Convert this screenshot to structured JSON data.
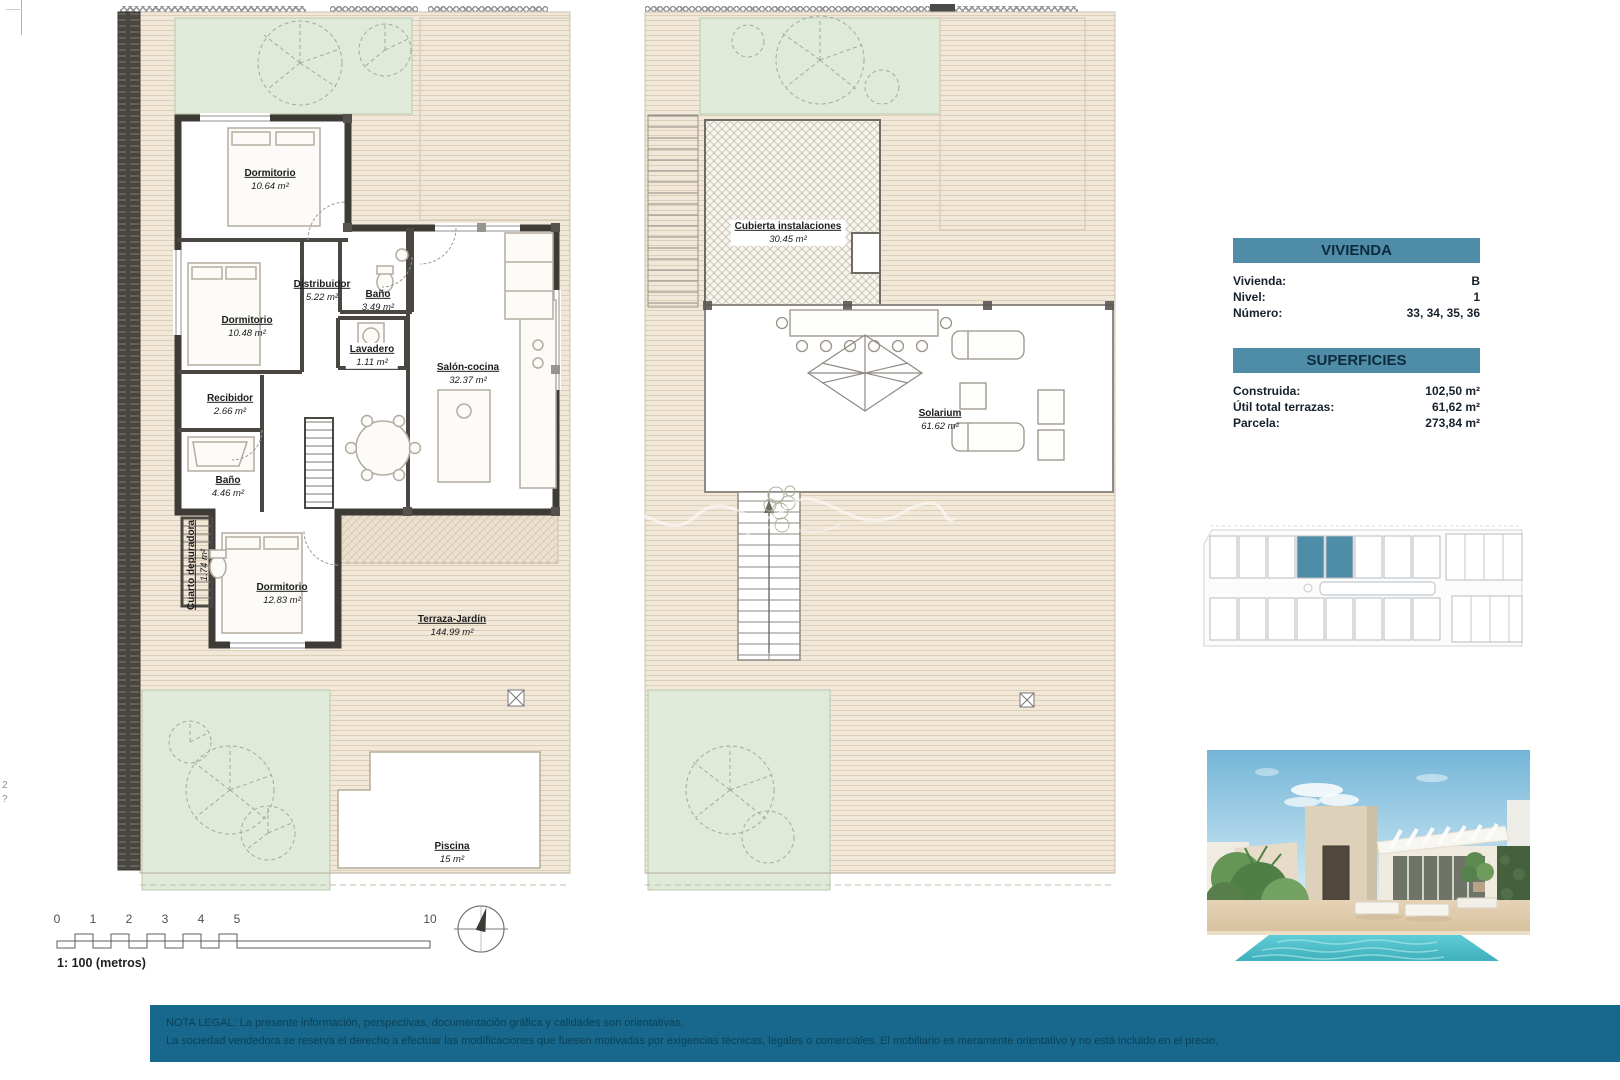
{
  "colors": {
    "accent": "#4e8ca8",
    "footer_bar": "#17688c",
    "footer_text": "#0a4157",
    "site_highlight": "#4e8ca8",
    "pool": "#4fc0ca"
  },
  "ground_plan": {
    "rooms": {
      "dormitorio1": {
        "label": "Dormitorio",
        "area": "10.64 m²"
      },
      "distribuidor": {
        "label": "Distribuidor",
        "area": "5.22 m²"
      },
      "bano1": {
        "label": "Baño",
        "area": "3.49 m²"
      },
      "dormitorio2": {
        "label": "Dormitorio",
        "area": "10.48 m²"
      },
      "lavadero": {
        "label": "Lavadero",
        "area": "1.11 m²"
      },
      "salon_cocina": {
        "label": "Salón-cocina",
        "area": "32.37 m²"
      },
      "recibidor": {
        "label": "Recibidor",
        "area": "2.66 m²"
      },
      "bano2": {
        "label": "Baño",
        "area": "4.46 m²"
      },
      "cuarto_depuradora": {
        "label": "Cuarto depuradora",
        "area": "1.74 m²"
      },
      "dormitorio3": {
        "label": "Dormitorio",
        "area": "12.83 m²"
      },
      "terraza_jardin": {
        "label": "Terraza-Jardín",
        "area": "144.99 m²"
      },
      "piscina": {
        "label": "Piscina",
        "area": "15 m²"
      }
    }
  },
  "solarium_plan": {
    "rooms": {
      "cubierta_instalaciones": {
        "label": "Cubierta instalaciones",
        "area": "30.45 m²"
      },
      "solarium": {
        "label": "Solarium",
        "area": "61.62 m²"
      }
    }
  },
  "info_panel": {
    "vivienda": {
      "header": "VIVIENDA",
      "rows": [
        {
          "label": "Vivienda:",
          "value": "B"
        },
        {
          "label": "Nivel:",
          "value": "1"
        },
        {
          "label": "Número:",
          "value": "33, 34, 35, 36"
        }
      ]
    },
    "superficies": {
      "header": "SUPERFICIES",
      "rows": [
        {
          "label": "Construida:",
          "value": "102,50 m²"
        },
        {
          "label": "Útil total terrazas:",
          "value": "61,62 m²"
        },
        {
          "label": "Parcela:",
          "value": "273,84 m²"
        }
      ]
    }
  },
  "scale_bar": {
    "ticks": [
      "0",
      "1",
      "2",
      "3",
      "4",
      "5",
      "10"
    ],
    "caption": "1: 100 (metros)"
  },
  "legal_note": {
    "line1": "NOTA LEGAL: La presente información, perspectivas, documentación gráfica y calidades son orientativas.",
    "line2": "La sociedad vendedora se reserva el derecho a efectuar las modificaciones que fuesen motivadas por exigencias técnicas, legales o comerciales. El mobiliario es meramente orientativo y no está incluido en el precio."
  },
  "edge_marks": {
    "top": "2",
    "bottom": "?"
  }
}
